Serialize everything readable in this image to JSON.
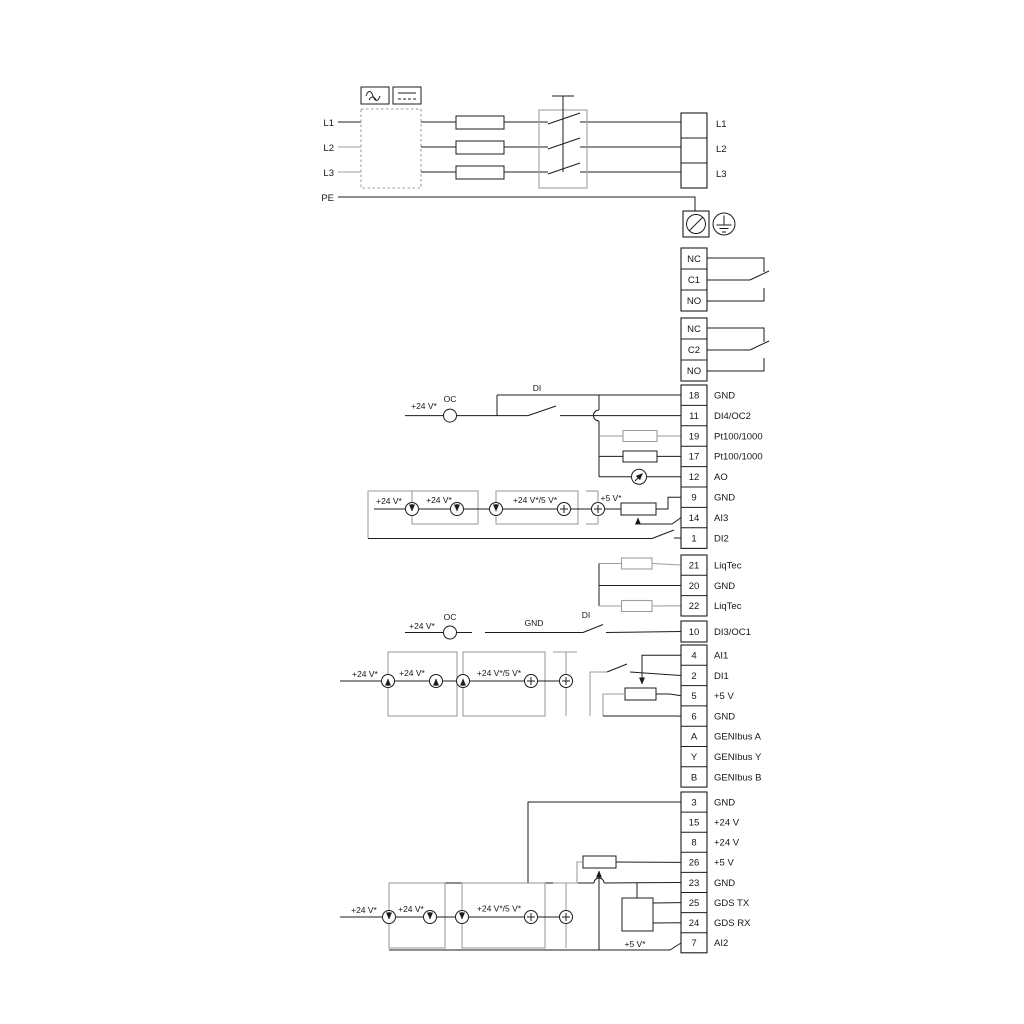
{
  "labels": {
    "v24": "+24 V*",
    "v24or5": "+24 V*/5 V*",
    "v5": "+5 V*",
    "oc": "OC",
    "di": "DI",
    "gnd": "GND"
  },
  "power": {
    "inputs": [
      "L1",
      "L2",
      "L3",
      "PE"
    ],
    "outputs": [
      "L1",
      "L2",
      "L3"
    ]
  },
  "relays": {
    "relay1": [
      "NC",
      "C1",
      "NO"
    ],
    "relay2": [
      "NC",
      "C2",
      "NO"
    ]
  },
  "strips": {
    "io1": [
      {
        "n": "18",
        "l": "GND"
      },
      {
        "n": "11",
        "l": "DI4/OC2"
      },
      {
        "n": "19",
        "l": "Pt100/1000"
      },
      {
        "n": "17",
        "l": "Pt100/1000"
      },
      {
        "n": "12",
        "l": "AO"
      },
      {
        "n": "9",
        "l": "GND"
      },
      {
        "n": "14",
        "l": "AI3"
      },
      {
        "n": "1",
        "l": "DI2"
      }
    ],
    "liqtec": [
      {
        "n": "21",
        "l": "LiqTec"
      },
      {
        "n": "20",
        "l": "GND"
      },
      {
        "n": "22",
        "l": "LiqTec"
      }
    ],
    "di3": [
      {
        "n": "10",
        "l": "DI3/OC1"
      }
    ],
    "io2": [
      {
        "n": "4",
        "l": "AI1"
      },
      {
        "n": "2",
        "l": "DI1"
      },
      {
        "n": "5",
        "l": "+5 V"
      },
      {
        "n": "6",
        "l": "GND"
      },
      {
        "n": "A",
        "l": "GENIbus A"
      },
      {
        "n": "Y",
        "l": "GENIbus Y"
      },
      {
        "n": "B",
        "l": "GENIbus B"
      }
    ],
    "io3": [
      {
        "n": "3",
        "l": "GND"
      },
      {
        "n": "15",
        "l": "+24 V"
      },
      {
        "n": "8",
        "l": "+24 V"
      },
      {
        "n": "26",
        "l": "+5 V"
      },
      {
        "n": "23",
        "l": "GND"
      },
      {
        "n": "25",
        "l": "GDS TX"
      },
      {
        "n": "24",
        "l": "GDS RX"
      },
      {
        "n": "7",
        "l": "AI2"
      }
    ]
  },
  "colors": {
    "wire": "#1c1c1c",
    "gray": "#9e9e9e"
  }
}
